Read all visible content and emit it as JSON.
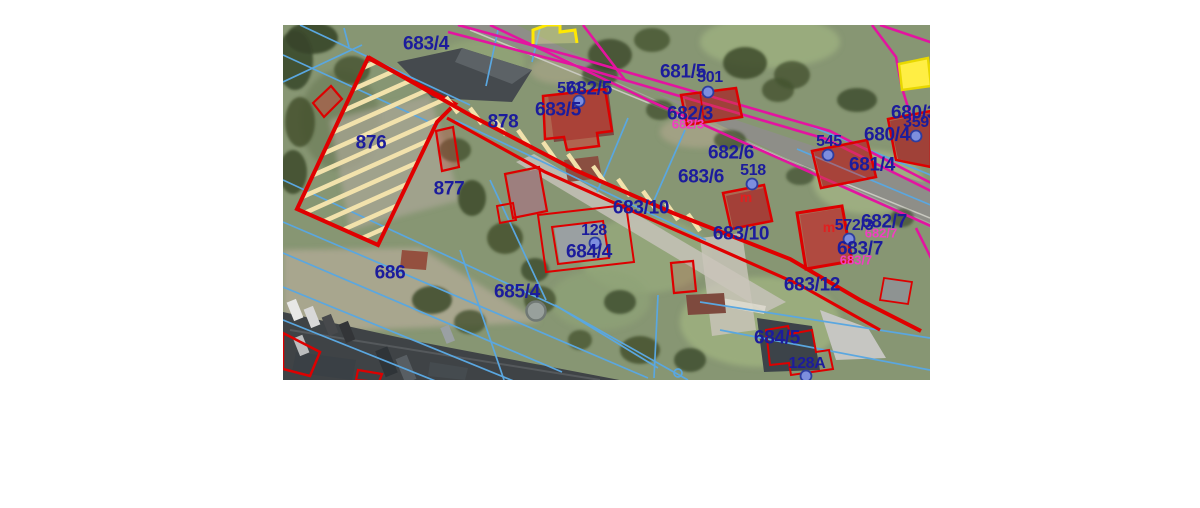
{
  "page": {
    "background": "#ffffff"
  },
  "map": {
    "x": 283,
    "y": 25,
    "width": 647,
    "height": 355,
    "description_label": "cadastral-parcel-aerial-map",
    "palette": {
      "parcel_label": "#1c1c9c",
      "pink_label": "#f23dc3",
      "building_mark": "#e02020",
      "red_boundary": "#e00000",
      "magenta_boundary": "#e314a0",
      "blue_boundary": "#5aa7e0",
      "hatch": "#f2e2ac",
      "yellow_parcel": "#ffee44",
      "address_dot_fill": "#7d8ede",
      "address_dot_stroke": "#2d3da0"
    },
    "highlight": {
      "parcel": "876",
      "style": "red outline with cream diagonal hatch"
    },
    "labels": [
      {
        "text": "683/4",
        "x": 426,
        "y": 44,
        "kind": "parcel"
      },
      {
        "text": "682/5",
        "x": 589,
        "y": 89,
        "kind": "parcel"
      },
      {
        "text": "683/5",
        "x": 558,
        "y": 110,
        "kind": "parcel"
      },
      {
        "text": "878",
        "x": 503,
        "y": 122,
        "kind": "parcel"
      },
      {
        "text": "876",
        "x": 371,
        "y": 143,
        "kind": "parcel"
      },
      {
        "text": "877",
        "x": 449,
        "y": 189,
        "kind": "parcel"
      },
      {
        "text": "681/5",
        "x": 683,
        "y": 72,
        "kind": "parcel"
      },
      {
        "text": "682/3",
        "x": 690,
        "y": 114,
        "kind": "parcel"
      },
      {
        "text": "682/3",
        "x": 688,
        "y": 124,
        "kind": "pink"
      },
      {
        "text": "682/6",
        "x": 731,
        "y": 153,
        "kind": "parcel"
      },
      {
        "text": "683/6",
        "x": 701,
        "y": 177,
        "kind": "parcel"
      },
      {
        "text": "680/3",
        "x": 914,
        "y": 113,
        "kind": "parcel"
      },
      {
        "text": "680/4",
        "x": 887,
        "y": 135,
        "kind": "parcel"
      },
      {
        "text": "681/4",
        "x": 872,
        "y": 165,
        "kind": "parcel"
      },
      {
        "text": "683/10",
        "x": 641,
        "y": 208,
        "kind": "parcel"
      },
      {
        "text": "683/10",
        "x": 741,
        "y": 234,
        "kind": "parcel"
      },
      {
        "text": "684/4",
        "x": 589,
        "y": 252,
        "kind": "parcel"
      },
      {
        "text": "682/7",
        "x": 884,
        "y": 222,
        "kind": "parcel"
      },
      {
        "text": "682/7",
        "x": 881,
        "y": 233,
        "kind": "pink"
      },
      {
        "text": "683/7",
        "x": 860,
        "y": 249,
        "kind": "parcel"
      },
      {
        "text": "683/7",
        "x": 856,
        "y": 260,
        "kind": "pink"
      },
      {
        "text": "683/12",
        "x": 812,
        "y": 285,
        "kind": "parcel"
      },
      {
        "text": "686",
        "x": 390,
        "y": 273,
        "kind": "parcel"
      },
      {
        "text": "685/4",
        "x": 517,
        "y": 292,
        "kind": "parcel"
      },
      {
        "text": "684/5",
        "x": 777,
        "y": 338,
        "kind": "parcel"
      },
      {
        "text": "571",
        "x": 570,
        "y": 89,
        "kind": "address"
      },
      {
        "text": "501",
        "x": 710,
        "y": 78,
        "kind": "address"
      },
      {
        "text": "518",
        "x": 753,
        "y": 171,
        "kind": "address"
      },
      {
        "text": "545",
        "x": 829,
        "y": 142,
        "kind": "address"
      },
      {
        "text": "359",
        "x": 916,
        "y": 123,
        "kind": "address"
      },
      {
        "text": "128",
        "x": 594,
        "y": 231,
        "kind": "address"
      },
      {
        "text": "572/3",
        "x": 854,
        "y": 226,
        "kind": "address"
      },
      {
        "text": "128A",
        "x": 807,
        "y": 364,
        "kind": "address"
      },
      {
        "text": "m",
        "x": 746,
        "y": 197,
        "kind": "mark"
      },
      {
        "text": "m",
        "x": 829,
        "y": 227,
        "kind": "mark"
      }
    ],
    "address_points": [
      {
        "label": "571",
        "x": 579,
        "y": 101
      },
      {
        "label": "501",
        "x": 708,
        "y": 92
      },
      {
        "label": "518",
        "x": 752,
        "y": 184
      },
      {
        "label": "545",
        "x": 828,
        "y": 155
      },
      {
        "label": "359",
        "x": 916,
        "y": 136
      },
      {
        "label": "128",
        "x": 595,
        "y": 243
      },
      {
        "label": "572/3",
        "x": 849,
        "y": 239
      },
      {
        "label": "128A",
        "x": 806,
        "y": 376
      }
    ]
  }
}
